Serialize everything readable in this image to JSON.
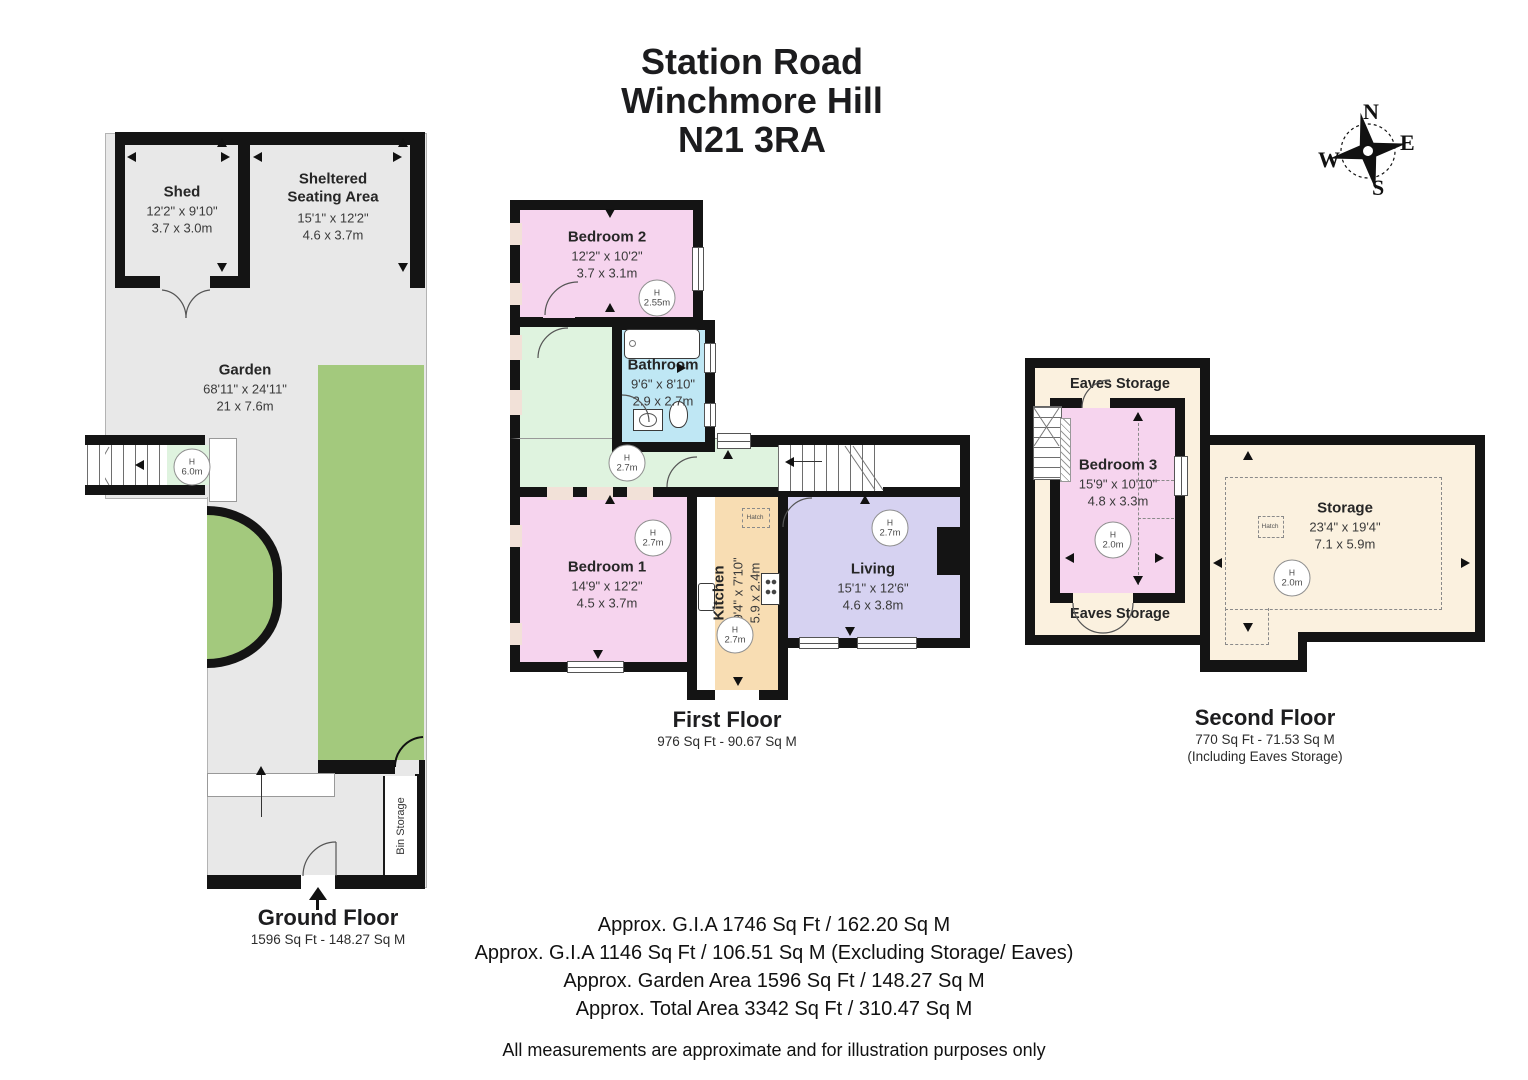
{
  "title": {
    "line1": "Station Road",
    "line2": "Winchmore Hill",
    "line3": "N21 3RA"
  },
  "compass": {
    "n": "N",
    "e": "E",
    "s": "S",
    "w": "W"
  },
  "labels": {
    "h": "H"
  },
  "ground": {
    "floor_label": "Ground Floor",
    "floor_area": "1596 Sq Ft - 148.27 Sq M",
    "shed": {
      "name": "Shed",
      "ft": "12'2\" x 9'10\"",
      "m": "3.7 x 3.0m"
    },
    "sheltered": {
      "name": "Sheltered Seating Area",
      "ft": "15'1\" x 12'2\"",
      "m": "4.6 x 3.7m"
    },
    "garden": {
      "name": "Garden",
      "ft": "68'11\" x 24'11\"",
      "m": "21 x 7.6m",
      "stair_height": "6.0m"
    },
    "bin": {
      "name": "Bin Storage"
    }
  },
  "first": {
    "floor_label": "First Floor",
    "floor_area": "976 Sq Ft - 90.67 Sq M",
    "bedroom2": {
      "name": "Bedroom 2",
      "ft": "12'2\" x 10'2\"",
      "m": "3.7 x 3.1m",
      "height": "2.55m"
    },
    "bathroom": {
      "name": "Bathroom",
      "ft": "9'6\" x 8'10\"",
      "m": "2.9 x 2.7m"
    },
    "hall": {
      "height": "2.7m"
    },
    "bedroom1": {
      "name": "Bedroom 1",
      "ft": "14'9\" x 12'2\"",
      "m": "4.5 x 3.7m",
      "height": "2.7m"
    },
    "kitchen": {
      "name": "Kitchen",
      "ft": "19'4\" x 7'10\"",
      "m": "5.9 x 2.4m",
      "height": "2.7m",
      "hatch": "Hatch"
    },
    "living": {
      "name": "Living",
      "ft": "15'1\" x 12'6\"",
      "m": "4.6 x 3.8m",
      "height": "2.7m"
    }
  },
  "second": {
    "floor_label": "Second Floor",
    "floor_area": "770 Sq Ft - 71.53 Sq M",
    "floor_note": "(Including Eaves Storage)",
    "eaves_top": {
      "name": "Eaves Storage"
    },
    "eaves_bottom": {
      "name": "Eaves Storage"
    },
    "bedroom3": {
      "name": "Bedroom 3",
      "ft": "15'9\" x 10'10\"",
      "m": "4.8 x 3.3m",
      "height": "2.0m"
    },
    "storage": {
      "name": "Storage",
      "ft": "23'4\" x 19'4\"",
      "m": "7.1 x 5.9m",
      "height": "2.0m",
      "hatch": "Hatch"
    }
  },
  "footer": {
    "lines": [
      "Approx. G.I.A 1746 Sq Ft / 162.20 Sq M",
      "Approx. G.I.A 1146 Sq Ft / 106.51 Sq M (Excluding Storage/ Eaves)",
      "Approx. Garden Area 1596 Sq Ft / 148.27 Sq M",
      "Approx. Total Area 3342 Sq Ft / 310.47 Sq M"
    ],
    "note": "All measurements are approximate and for illustration purposes only"
  },
  "colors": {
    "wall": "#141414",
    "floor_gray": "#e8e8e8",
    "lawn": "#a3c97d",
    "hall_green": "#dff3df",
    "bedroom_pink": "#f6d4ee",
    "bath_blue": "#bfe7f4",
    "kitchen_tan": "#f8ddb3",
    "living_lavender": "#d6d2f1",
    "eaves_cream": "#fbf1df"
  }
}
